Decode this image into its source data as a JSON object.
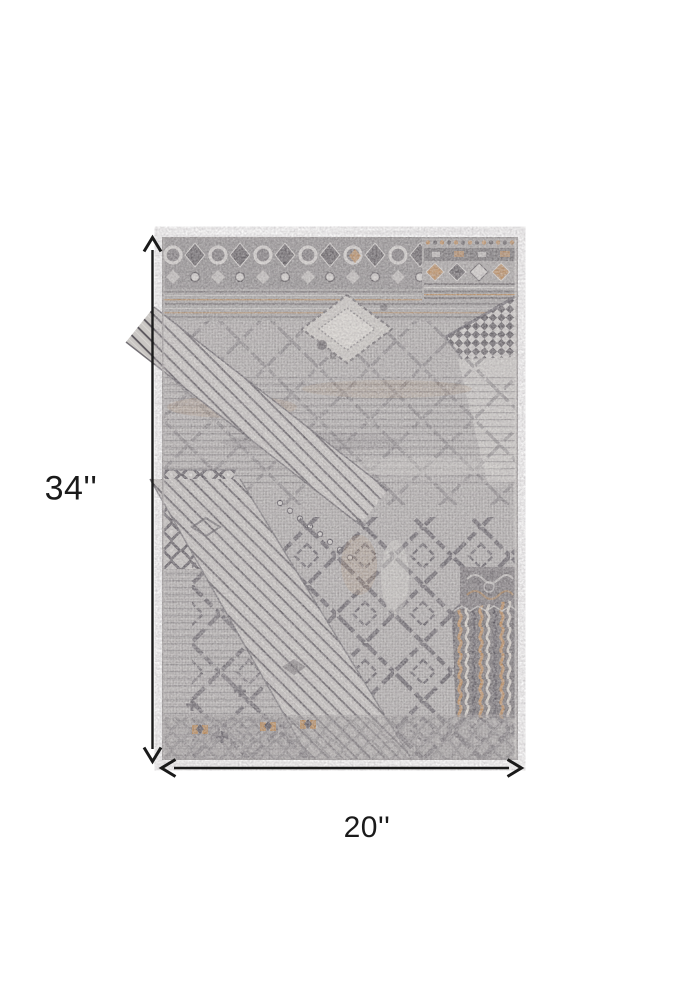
{
  "image": {
    "kind": "product-dimension-diagram",
    "subject": "Distressed gray patchwork area rug",
    "background": "#ffffff"
  },
  "dimensions": {
    "height": {
      "label": "34''",
      "value": 34,
      "unit": "in"
    },
    "width": {
      "label": "20''",
      "value": 20,
      "unit": "in"
    }
  },
  "annotations": {
    "height_arrow": "vertical-double-headed-arrow",
    "width_arrow": "horizontal-double-headed-arrow",
    "arrow_color": "#1a1a1a"
  },
  "rug_palette": {
    "base_gray": "#b1aead",
    "light_gray": "#d6d3d0",
    "mid_gray": "#8f8c8d",
    "dark_slate": "#57535a",
    "accent_tan": "#bd8a58",
    "accent_rust": "#a97a4a"
  }
}
